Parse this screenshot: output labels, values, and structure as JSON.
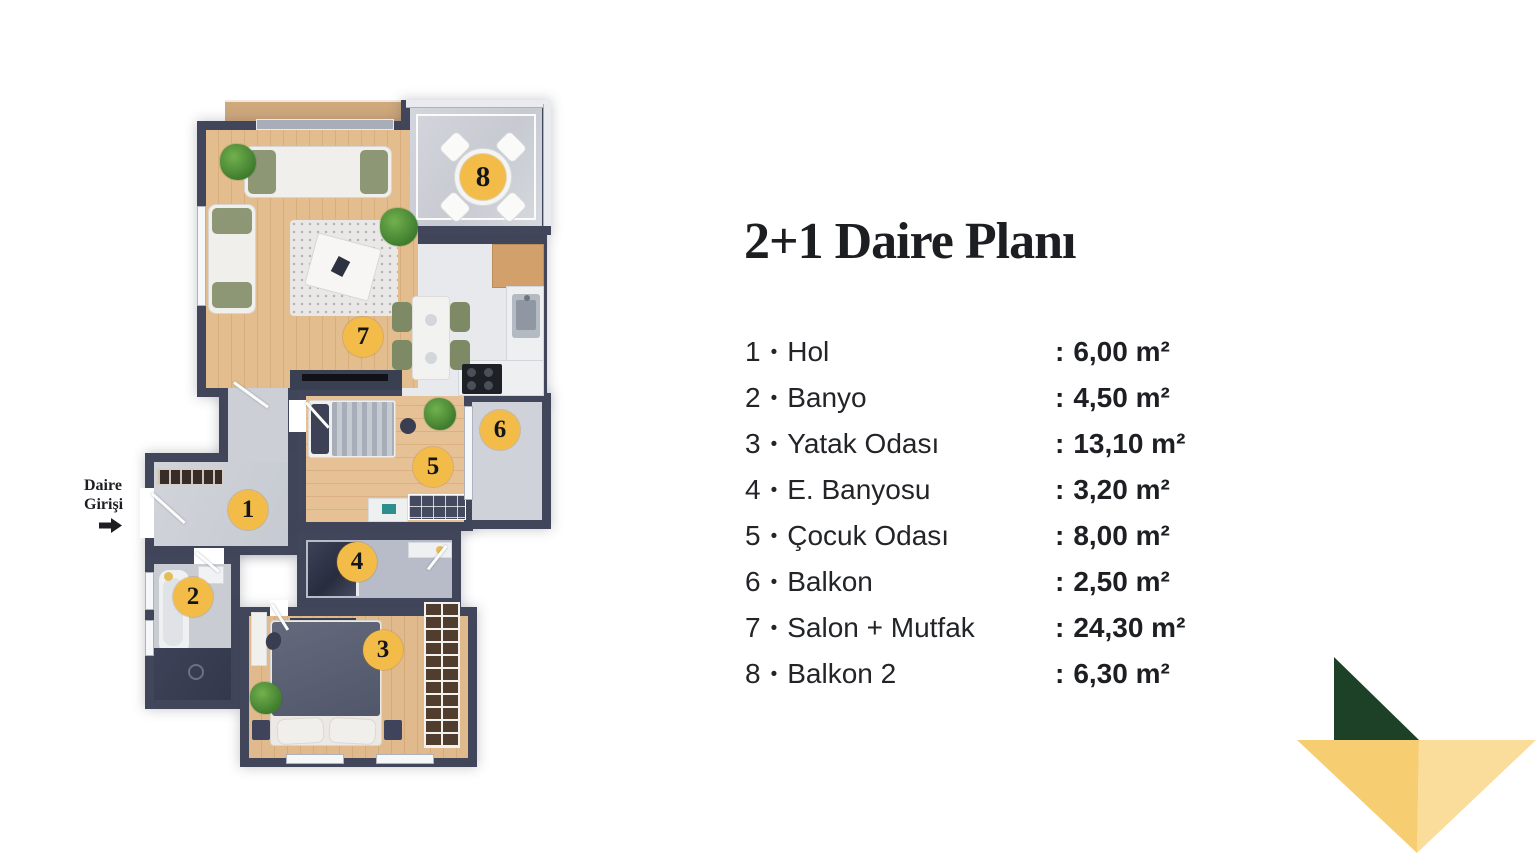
{
  "title": "2+1 Daire Planı",
  "entrance_label": {
    "line1": "Daire",
    "line2": "Girişi"
  },
  "legend": {
    "separator": "•",
    "colon": ":",
    "items": [
      {
        "num": "1",
        "name": "Hol",
        "area": "6,00 m²"
      },
      {
        "num": "2",
        "name": "Banyo",
        "area": "4,50 m²"
      },
      {
        "num": "3",
        "name": "Yatak Odası",
        "area": "13,10 m²"
      },
      {
        "num": "4",
        "name": "E. Banyosu",
        "area": "3,20 m²"
      },
      {
        "num": "5",
        "name": "Çocuk Odası",
        "area": "8,00 m²"
      },
      {
        "num": "6",
        "name": "Balkon",
        "area": "2,50 m²"
      },
      {
        "num": "7",
        "name": "Salon + Mutfak",
        "area": "24,30 m²"
      },
      {
        "num": "8",
        "name": "Balkon 2",
        "area": "6,30 m²"
      }
    ]
  },
  "plan": {
    "badges": [
      "1",
      "2",
      "3",
      "4",
      "5",
      "6",
      "7",
      "8"
    ]
  },
  "colors": {
    "badge_yellow": "#F3BC49",
    "wall": "#42465A",
    "deco_green": "#1D4126",
    "deco_yellow_dark": "#F7CD72",
    "deco_yellow_light": "#FADC9B"
  }
}
